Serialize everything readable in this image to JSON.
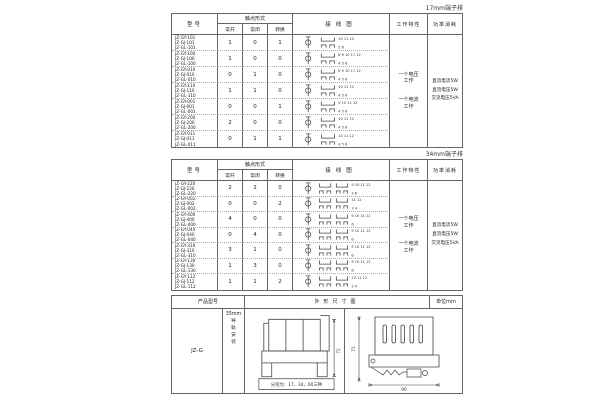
{
  "section17": {
    "corner_label": "17mm端子排",
    "headers": {
      "model": "型号",
      "contact_form": "触点形式",
      "no": "常开",
      "nc": "常闭",
      "co": "转换",
      "wiring": "接线图",
      "work": "工作特性",
      "power": "功率消耗"
    },
    "work_items": [
      "一个电压工作",
      "一个电流工作"
    ],
    "power_items": [
      "直流电流5W",
      "直流电压5W",
      "交流电压5VA"
    ],
    "style": "single",
    "rows": [
      {
        "models": [
          "JZ-GY-101",
          "JZ-GJ-101",
          "JZ-GL-101"
        ],
        "no": "1",
        "nc": "0",
        "co": "1",
        "top_terminals": "10 11 12",
        "bottom_terminals": "5 6"
      },
      {
        "models": [
          "JZ-GY-100",
          "JZ-GJ-100",
          "JZ-GL-100"
        ],
        "no": "1",
        "nc": "0",
        "co": "0",
        "top_terminals": "8 9 10 11 12",
        "bottom_terminals": "4 5 6"
      },
      {
        "models": [
          "JZ-GY-010",
          "JZ-GJ-010",
          "JZ-GL-010"
        ],
        "no": "0",
        "nc": "1",
        "co": "0",
        "top_terminals": "8 9 10 11 12",
        "bottom_terminals": "4 5 6"
      },
      {
        "models": [
          "JZ-GY-110",
          "JZ-GJ-110",
          "JZ-GL-110"
        ],
        "no": "1",
        "nc": "1",
        "co": "0",
        "top_terminals": "10 11 12",
        "bottom_terminals": "4 5 6"
      },
      {
        "models": [
          "JZ-GY-001",
          "JZ-GJ-001",
          "JZ-GL-001"
        ],
        "no": "0",
        "nc": "0",
        "co": "1",
        "top_terminals": "9 10 11 12",
        "bottom_terminals": "4 5 6"
      },
      {
        "models": [
          "JZ-GY-200",
          "JZ-GJ-200",
          "JZ-GL-200"
        ],
        "no": "2",
        "nc": "0",
        "co": "0",
        "top_terminals": "10 11 12",
        "bottom_terminals": "4 5 6"
      },
      {
        "models": [
          "JZ-GY-011",
          "JZ-GJ-011",
          "JZ-GL-011"
        ],
        "no": "0",
        "nc": "1",
        "co": "1",
        "top_terminals": "10 11 12",
        "bottom_terminals": "4 5 6"
      }
    ]
  },
  "section34": {
    "corner_label": "34mm端子排",
    "headers": {
      "model": "型号",
      "contact_form": "触点形式",
      "no": "常开",
      "nc": "常闭",
      "co": "转换",
      "wiring": "接线图",
      "work": "工作特性",
      "power": "功率消耗"
    },
    "work_items": [
      "一个电压工作",
      "一个电流工作"
    ],
    "power_items": [
      "直流电流5W",
      "直流电压5W",
      "交流电压5VA"
    ],
    "style": "double",
    "rows": [
      {
        "models": [
          "JZ-GY-220",
          "JZ-GJ-220",
          "JZ-GL-220"
        ],
        "no": "2",
        "nc": "2",
        "co": "0",
        "top_terminals": "9 10  11 12",
        "bottom_terminals": "3 6"
      },
      {
        "models": [
          "JZ-GY-002",
          "JZ-GJ-002",
          "JZ-GL-002"
        ],
        "no": "0",
        "nc": "0",
        "co": "2",
        "top_terminals": "11 12",
        "bottom_terminals": "3 4"
      },
      {
        "models": [
          "JZ-GY-400",
          "JZ-GJ-400",
          "JZ-GL-400"
        ],
        "no": "4",
        "nc": "0",
        "co": "0",
        "top_terminals": "9 10  11 12",
        "bottom_terminals": "6"
      },
      {
        "models": [
          "JZ-GY-040",
          "JZ-GJ-040",
          "JZ-GL-040"
        ],
        "no": "0",
        "nc": "4",
        "co": "0",
        "top_terminals": "9 10  11 12",
        "bottom_terminals": "6"
      },
      {
        "models": [
          "JZ-GY-310",
          "JZ-GJ-310",
          "JZ-GL-310"
        ],
        "no": "3",
        "nc": "1",
        "co": "0",
        "top_terminals": "9 10  11 12",
        "bottom_terminals": "6"
      },
      {
        "models": [
          "JZ-GY-130",
          "JZ-GJ-130",
          "JZ-GL-130"
        ],
        "no": "1",
        "nc": "3",
        "co": "0",
        "top_terminals": "9 10  11 12",
        "bottom_terminals": "6"
      },
      {
        "models": [
          "JZ-GY-112",
          "JZ-GJ-112",
          "JZ-GL-112"
        ],
        "no": "1",
        "nc": "1",
        "co": "2",
        "top_terminals": "10 11  12",
        "bottom_terminals": "3 4"
      }
    ]
  },
  "outline": {
    "headers": {
      "product_model": "产品型号",
      "dimension_drawing": "外形尺寸图",
      "unit": "单位mm"
    },
    "model": "JZ-G",
    "mount_width": "35mm",
    "mount_label": "导轨安装",
    "front_caption": "分别为：17、34、60三种",
    "dims": {
      "front_height": "72",
      "side_height": "71",
      "side_depth": "90"
    }
  }
}
